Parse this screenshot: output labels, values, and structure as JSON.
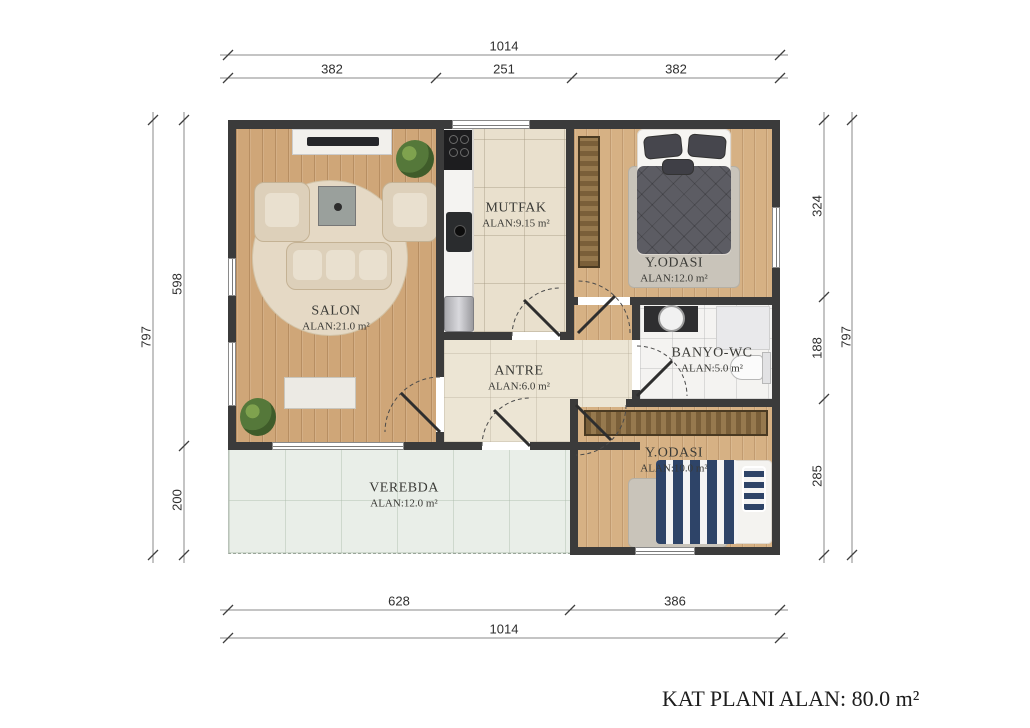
{
  "title": "KAT PLANI ALAN: 80.0 m²",
  "rooms": [
    {
      "name": "SALON",
      "area": "ALAN:21.0 m²"
    },
    {
      "name": "MUTFAK",
      "area": "ALAN:9.15 m²"
    },
    {
      "name": "Y.ODASI",
      "area": "ALAN:12.0 m²"
    },
    {
      "name": "BANYO-WC",
      "area": "ALAN:5.0 m²"
    },
    {
      "name": "ANTRE",
      "area": "ALAN:6.0 m²"
    },
    {
      "name": "Y.ODASI",
      "area": "ALAN:10.0 m²"
    },
    {
      "name": "VEREBDA",
      "area": "ALAN:12.0 m²"
    }
  ],
  "dims": {
    "top_total": "1014",
    "top_segments": [
      "382",
      "251",
      "382"
    ],
    "left_total": "797",
    "left_segments": [
      "598",
      "200"
    ],
    "right_segments": [
      "324",
      "188",
      "285"
    ],
    "right_total": "797",
    "bottom_segments": [
      "628",
      "386"
    ],
    "bottom_total": "1014"
  },
  "colors": {
    "wall": "#3b3b3b",
    "wood_salon": "#cfa678",
    "wood_bedroom": "#d6b184",
    "tile_kitchen": "#e9e0cd",
    "tile_antre": "#ece5d4",
    "bathroom": "#f4f3f1",
    "veranda": "#e9eee8",
    "navy_accent": "#2e4468"
  }
}
